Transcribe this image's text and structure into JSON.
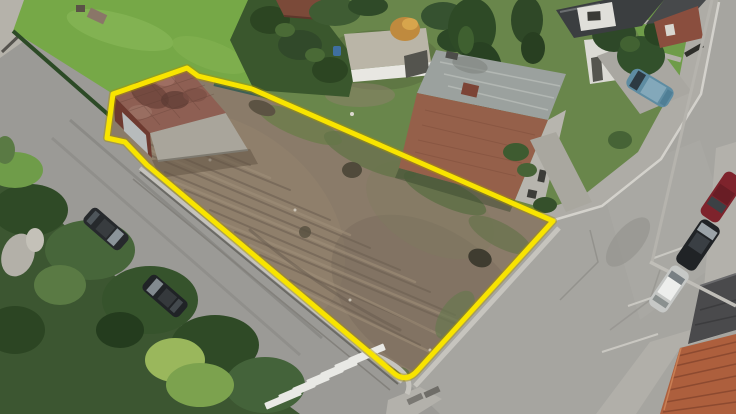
{
  "scene": {
    "description": "Aerial drone photograph of a cleared, tilled building plot at a street corner, outlined with a thick yellow boundary line",
    "objects": {
      "plot": "vacant-dirt-plot",
      "outline": "yellow-plot-boundary",
      "garage": "small-garage-red-tile-roof",
      "house": "two-storey-brick-house-grey-roof",
      "white_shed_1": "white-garden-garage",
      "white_shed_2": "white-shed-beside-house",
      "crosswalk": "zebra-crossing",
      "cars_left": "two-dark-cars-parked-left-street",
      "cars_right": "red-black-silver-cars-parked-right-street",
      "minivan": "blue-minivan-on-driveway",
      "vegetation": "hedges-trees-lawns",
      "roofs_bottom_right": "neighbouring-house-roofs"
    },
    "colors": {
      "outline": "#f8e400",
      "outline_edge": "#a89400",
      "road_left": "#9b9a96",
      "road_right": "#a6a5a0",
      "sidewalk": "#aeaca6",
      "sidewalk_light": "#b3b1ab",
      "concrete_pad": "#b5b2aa",
      "dirt": "#8a7b69",
      "dirt_dark": "#6f6254",
      "dirt_light": "#9e8e79",
      "lawn": "#76a847",
      "lawn_right": "#6f9c49",
      "garden": "#69864b",
      "hedge": "#3a572d",
      "tree_dark": "#2e4a26",
      "tree_mid": "#47663a",
      "tree_light": "#7ca24e",
      "bush_yellow": "#9ab75c",
      "garage_roof": "#8e5f53",
      "garage_brick": "#6e3a30",
      "garage_door": "#b7bbbc",
      "garage_side": "#a9a59b",
      "house_brick": "#95604a",
      "house_roof": "#9ba19e",
      "house_facade": "#b7b5ae",
      "shed_white": "#e8e7e2",
      "shed_roof": "#bab5a7",
      "crosswalk": "#e9e9e5",
      "curb_white": "#d8d6d0",
      "car_dark": "#26292c",
      "car_black": "#202326",
      "car_red": "#7e232c",
      "car_silver": "#c6c8c6",
      "minivan_blue": "#5e8ca2",
      "tile_roof": "#ad5f3d",
      "dark_roof": "#4a4a4c",
      "orange_bush": "#bf8a3e"
    }
  }
}
